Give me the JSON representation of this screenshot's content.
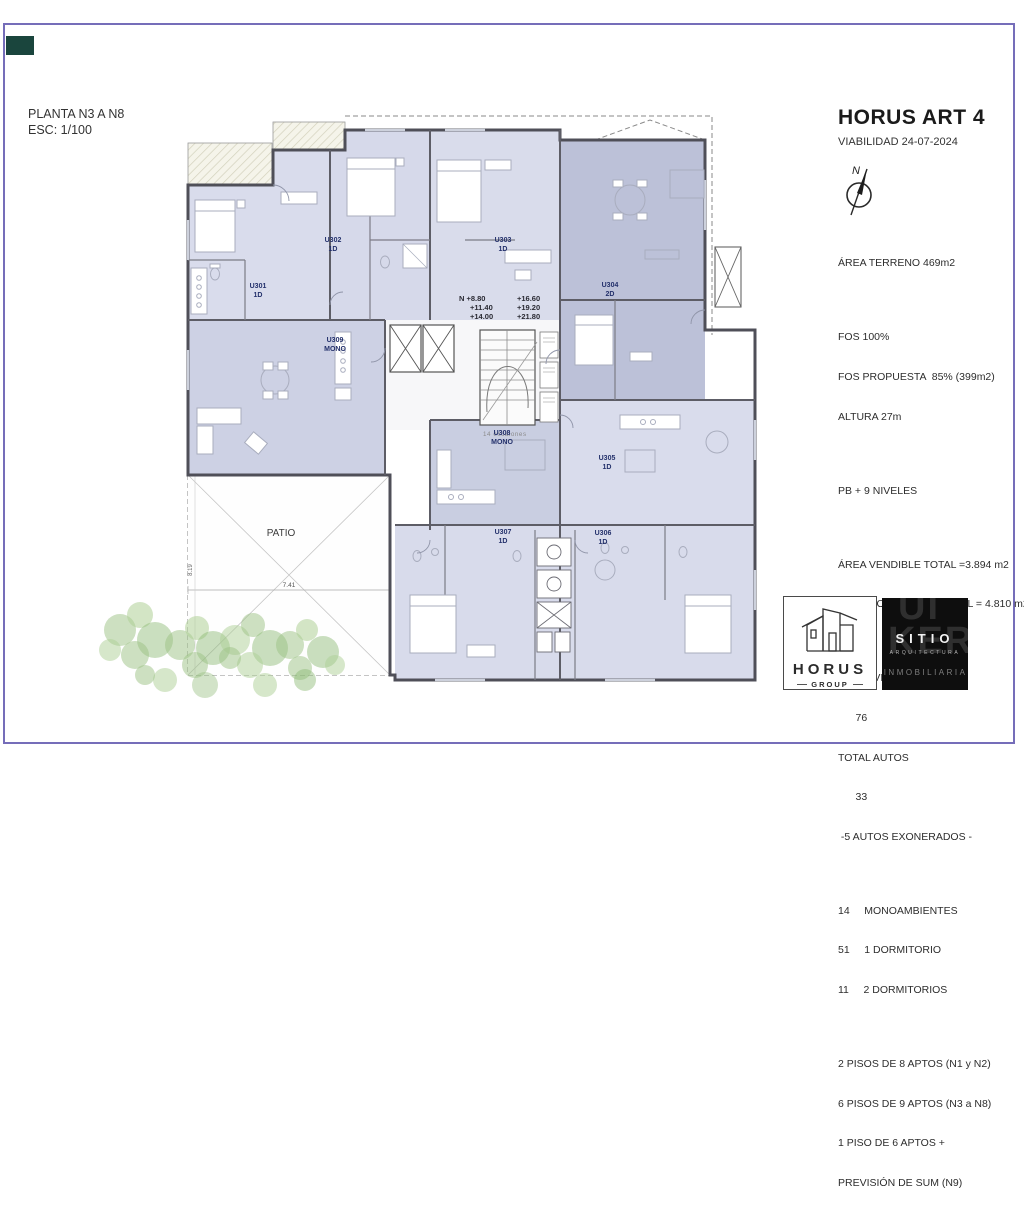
{
  "page": {
    "border_color": "#756db9",
    "corner_color": "#1a453d"
  },
  "title_block": {
    "plan_title": "PLANTA N3 A N8",
    "scale": "ESC: 1/100"
  },
  "info_panel": {
    "title": "HORUS ART 4",
    "subtitle": "VIABILIDAD 24-07-2024",
    "north_label": "N",
    "lines": [
      "ÁREA TERRENO 469m2",
      "",
      "FOS 100%",
      "FOS PROPUESTA  85% (399m2)",
      "ALTURA 27m",
      "",
      "PB + 9 NIVELES",
      "",
      "ÁREA VENDIBLE TOTAL =3.894 m2",
      "ÁREA CONSTRUIDA TOTAL = 4.810 m2",
      "",
      "TOTAL VIVIENDAS",
      "      76",
      "TOTAL AUTOS",
      "      33",
      " -5 AUTOS EXONERADOS -",
      "",
      "14     MONOAMBIENTES",
      "51     1 DORMITORIO",
      "11     2 DORMITORIOS",
      "",
      "2 PISOS DE 8 APTOS (N1 y N2)",
      "6 PISOS DE 9 APTOS (N3 a N8)",
      "1 PISO DE 6 APTOS +",
      "PREVISIÓN DE SUM (N9)"
    ]
  },
  "plan": {
    "units": [
      {
        "id": "U301",
        "type": "1D"
      },
      {
        "id": "U302",
        "type": "1D"
      },
      {
        "id": "U303",
        "type": "1D"
      },
      {
        "id": "U304",
        "type": "2D"
      },
      {
        "id": "U305",
        "type": "1D"
      },
      {
        "id": "U306",
        "type": "1D"
      },
      {
        "id": "U307",
        "type": "1D"
      },
      {
        "id": "U308",
        "type": "MONO"
      },
      {
        "id": "U309",
        "type": "MONO"
      }
    ],
    "levels_left": [
      "N +8.80",
      "+11.40",
      "+14.00"
    ],
    "levels_right": [
      "+16.60",
      "+19.20",
      "+21.80"
    ],
    "stairs_note": "14  escalones",
    "patio_label": "PATIO",
    "dim_h": "7.41",
    "dim_v": "8.19"
  },
  "logos": {
    "horus": {
      "name": "HORUS",
      "sub": "GROUP"
    },
    "sitio": {
      "name": "SITIO",
      "sub": "ARQUITECTURA",
      "tagline": "INMOBILIARIA",
      "ghost_top": "UI",
      "ghost_mid": "KER"
    }
  }
}
